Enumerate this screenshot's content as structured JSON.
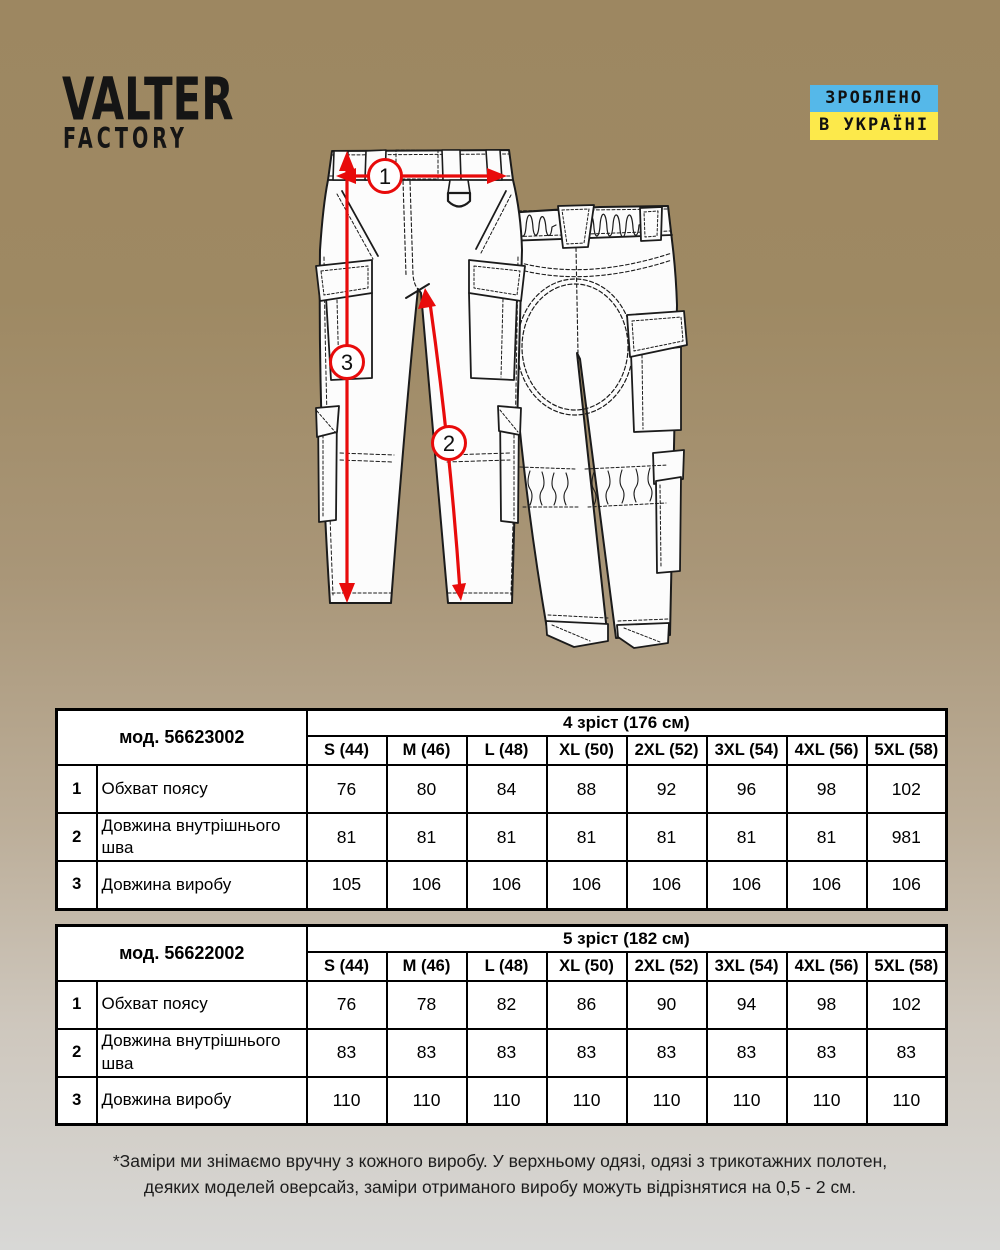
{
  "brand": {
    "line1": "VALTER",
    "line2": "FACTORY"
  },
  "made_in_badge": {
    "line1": "ЗРОБЛЕНО",
    "line2": "В УКРАЇНІ",
    "line1_bg": "#55b8e9",
    "line2_bg": "#fce94b",
    "text_color": "#111111"
  },
  "diagram": {
    "type": "pants-technical-drawing-front-and-back",
    "markers": [
      "1",
      "2",
      "3"
    ],
    "arrow_color": "#e80b0b"
  },
  "tables": [
    {
      "model": "мод. 56623002",
      "height_group": "4 зріст (176 см)",
      "sizes": [
        "S (44)",
        "M (46)",
        "L (48)",
        "XL (50)",
        "2XL (52)",
        "3XL (54)",
        "4XL (56)",
        "5XL (58)"
      ],
      "rows": [
        {
          "num": "1",
          "label": "Обхват поясу",
          "values": [
            "76",
            "80",
            "84",
            "88",
            "92",
            "96",
            "98",
            "102"
          ]
        },
        {
          "num": "2",
          "label": "Довжина внутрішнього шва",
          "values": [
            "81",
            "81",
            "81",
            "81",
            "81",
            "81",
            "81",
            "981"
          ]
        },
        {
          "num": "3",
          "label": "Довжина виробу",
          "values": [
            "105",
            "106",
            "106",
            "106",
            "106",
            "106",
            "106",
            "106"
          ]
        }
      ]
    },
    {
      "model": "мод. 56622002",
      "height_group": "5 зріст (182 см)",
      "sizes": [
        "S (44)",
        "M (46)",
        "L (48)",
        "XL (50)",
        "2XL (52)",
        "3XL (54)",
        "4XL (56)",
        "5XL (58)"
      ],
      "rows": [
        {
          "num": "1",
          "label": "Обхват поясу",
          "values": [
            "76",
            "78",
            "82",
            "86",
            "90",
            "94",
            "98",
            "102"
          ]
        },
        {
          "num": "2",
          "label": "Довжина внутрішнього шва",
          "values": [
            "83",
            "83",
            "83",
            "83",
            "83",
            "83",
            "83",
            "83"
          ]
        },
        {
          "num": "3",
          "label": "Довжина виробу",
          "values": [
            "110",
            "110",
            "110",
            "110",
            "110",
            "110",
            "110",
            "110"
          ]
        }
      ]
    }
  ],
  "footnote": {
    "line1": "*Заміри ми знімаємо вручну з кожного виробу. У верхньому одязі, одязі з трикотажних полотен,",
    "line2": "деяких моделей оверсайз, заміри отриманого виробу можуть відрізнятися на 0,5 - 2 см."
  }
}
